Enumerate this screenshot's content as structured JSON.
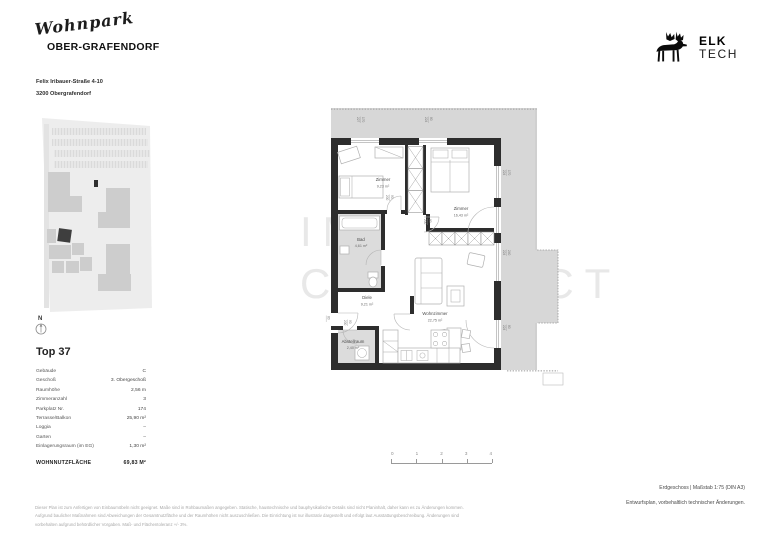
{
  "colors": {
    "plan_background": "#d7d7d7",
    "wall": "#2d2d2d",
    "highlight_building": "#3e3e3e"
  },
  "header": {
    "brand_script": "Wohnpark",
    "brand_name": "OBER-GRAFENDORF",
    "address_line1": "Felix Iribauer-Straße 4-10",
    "address_line2": "3200 Obergrafendorf",
    "logo_name": "ELK",
    "logo_sub": "TECH"
  },
  "siteplan": {
    "compass_label": "N"
  },
  "unit": {
    "title": "Top 37",
    "rows": [
      {
        "label": "Gebäude",
        "value": "C"
      },
      {
        "label": "Geschoß",
        "value": "3. Obergeschoß"
      },
      {
        "label": "Raumhöhe",
        "value": "2,56 m"
      },
      {
        "label": "Zimmeranzahl",
        "value": "3"
      },
      {
        "label": "Parkplatz Nr.",
        "value": "174"
      },
      {
        "label": "Terrasse/Balkon",
        "value": "25,90 m²"
      },
      {
        "label": "Loggia",
        "value": "–"
      },
      {
        "label": "Garten",
        "value": "–"
      },
      {
        "label": "Einlagerungsraum (im EG)",
        "value": "1,30 m²"
      }
    ],
    "total_label": "WOHNNUTZFLÄCHE",
    "total_value": "69,83 M²"
  },
  "plan": {
    "watermark_line1": "IMMO",
    "watermark_line2": "CONTRACT",
    "rooms": [
      {
        "name": "Zimmer",
        "area": "9,23 m²"
      },
      {
        "name": "Zimmer",
        "area": "16,43 m²"
      },
      {
        "name": "Bad",
        "area": "4,61 m²"
      },
      {
        "name": "Diele",
        "area": "9,21 m²"
      },
      {
        "name": "Wohnzimmer",
        "area": "22,75 m²"
      },
      {
        "name": "Abstellraum",
        "area": "2,40 m²"
      }
    ],
    "dims": [
      {
        "a": "170",
        "b": "227"
      },
      {
        "a": "80",
        "b": "224"
      },
      {
        "a": "170",
        "b": "224"
      },
      {
        "a": "240",
        "b": "224"
      },
      {
        "a": "80",
        "b": "224"
      },
      {
        "a": "80",
        "b": "200"
      },
      {
        "a": "90",
        "b": "200"
      },
      {
        "a": "80",
        "b": "200"
      },
      {
        "a": "90",
        "b": "200"
      }
    ]
  },
  "scalebar": {
    "ticks": [
      "0",
      "1",
      "2",
      "3",
      "4"
    ]
  },
  "footer": {
    "plan_info": "Erdgeschoss | Maßstab 1:75 (DIN A3)",
    "note": "Entwurfsplan, vorbehaltlich technischer Änderungen.",
    "disclaimer_line1": "Dieser Plan ist zum Anfertigen von Einbaumöbeln nicht geeignet. Maße sind in Rohbaumaßen angegeben. Statische, haustechnische und bauphysikalische Details sind nicht Planinhalt, daher kann es zu Änderungen kommen.",
    "disclaimer_line2": "Aufgrund baulicher Maßnahmen sind Abweichungen der Gesamtnutzfläche und der Raumhöhen nicht auszuschließen. Die Einrichtung ist nur illustrativ dargestellt und erfolgt laut Ausstattungsbeschreibung. Änderungen sind",
    "disclaimer_line3": "vorbehalten aufgrund behördlicher Vorgaben. Maß- und Flächentoleranz +/- 3%."
  }
}
